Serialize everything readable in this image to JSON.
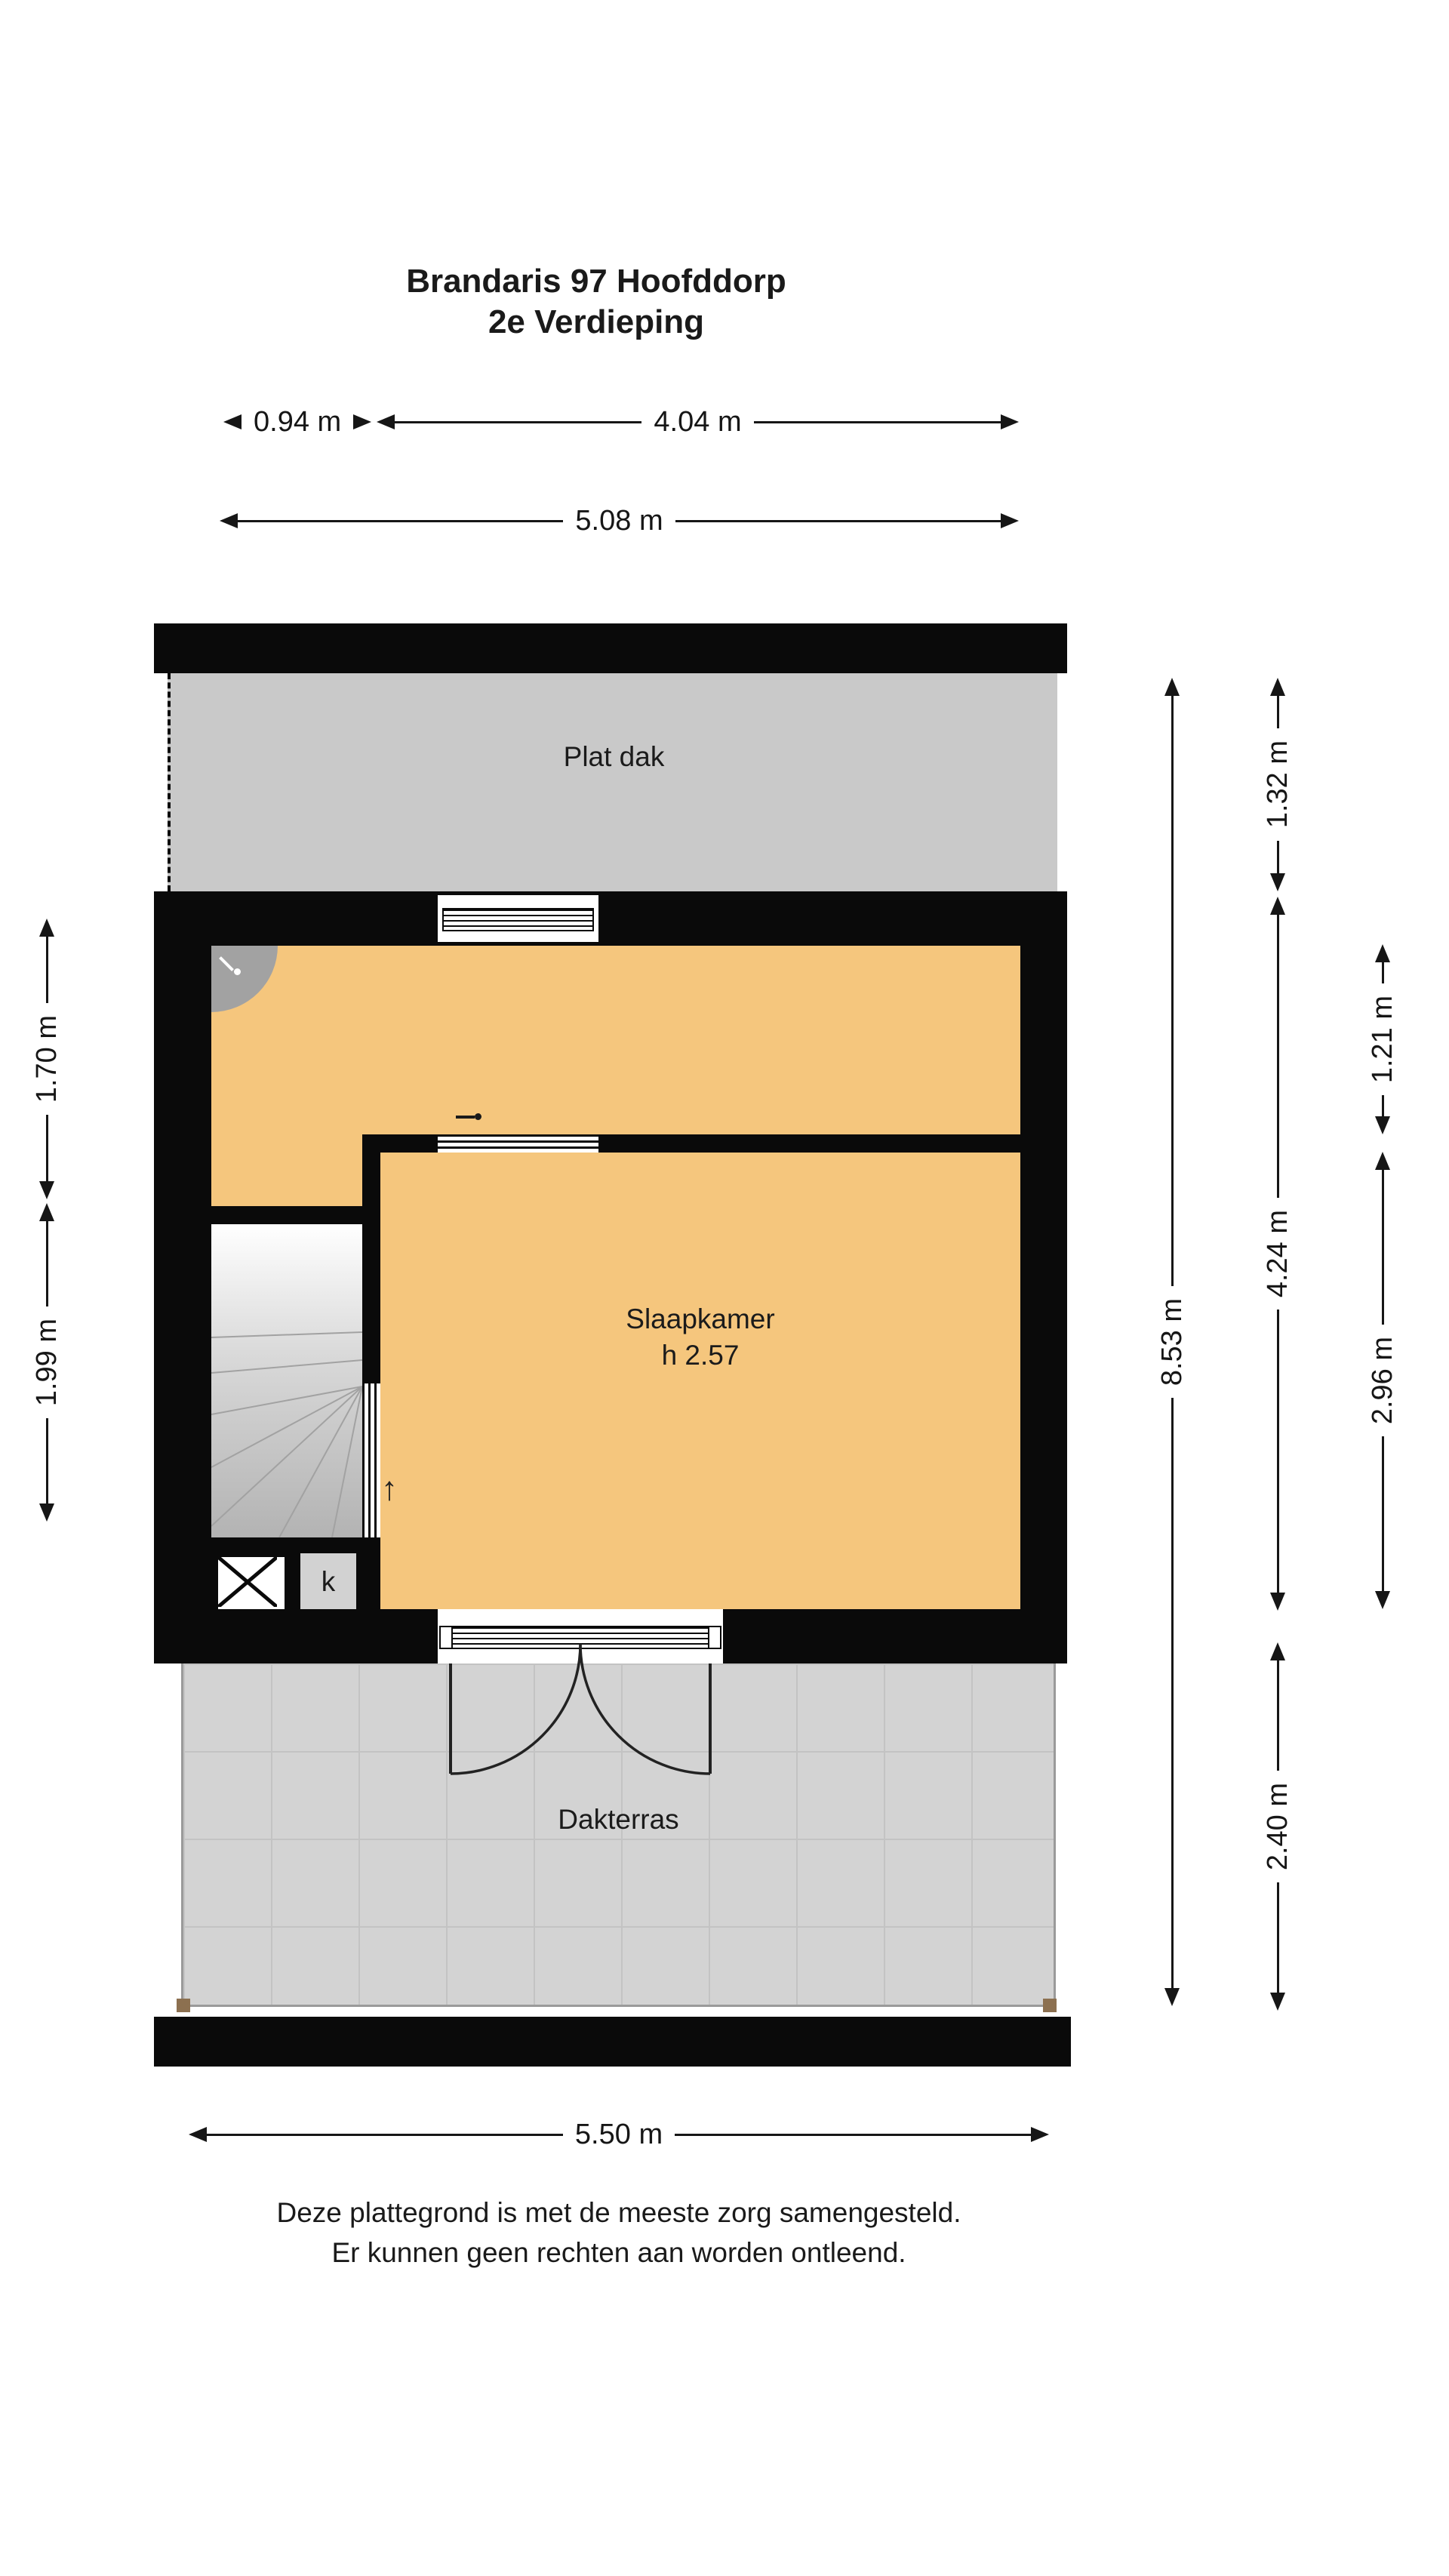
{
  "title": {
    "line1": "Brandaris 97 Hoofddorp",
    "line2": "2e Verdieping"
  },
  "rooms": {
    "flat_roof": "Plat dak",
    "bedroom": "Slaapkamer",
    "bedroom_height": "h 2.57",
    "terrace": "Dakterras",
    "closet": "k"
  },
  "dimensions": {
    "top_left": "0.94 m",
    "top_main": "4.04 m",
    "top_total": "5.08 m",
    "right_total": "8.53 m",
    "right_flat_roof": "1.32 m",
    "right_interior": "4.24 m",
    "right_terrace": "2.40 m",
    "right_landing": "1.21 m",
    "right_bedroom": "2.96 m",
    "left_landing": "1.70 m",
    "left_stairs": "1.99 m",
    "bottom_total": "5.50 m"
  },
  "icons": {
    "stairs_up_arrow": "↑"
  },
  "footer": {
    "line1": "Deze plattegrond is met de meeste zorg samengesteld.",
    "line2": "Er kunnen geen rechten aan worden ontleend."
  },
  "colors": {
    "wall": "#0a0a0a",
    "room_orange": "#f5c67d",
    "flat_roof_gray": "#c9c9c9",
    "terrace_gray": "#d3d3d3"
  }
}
